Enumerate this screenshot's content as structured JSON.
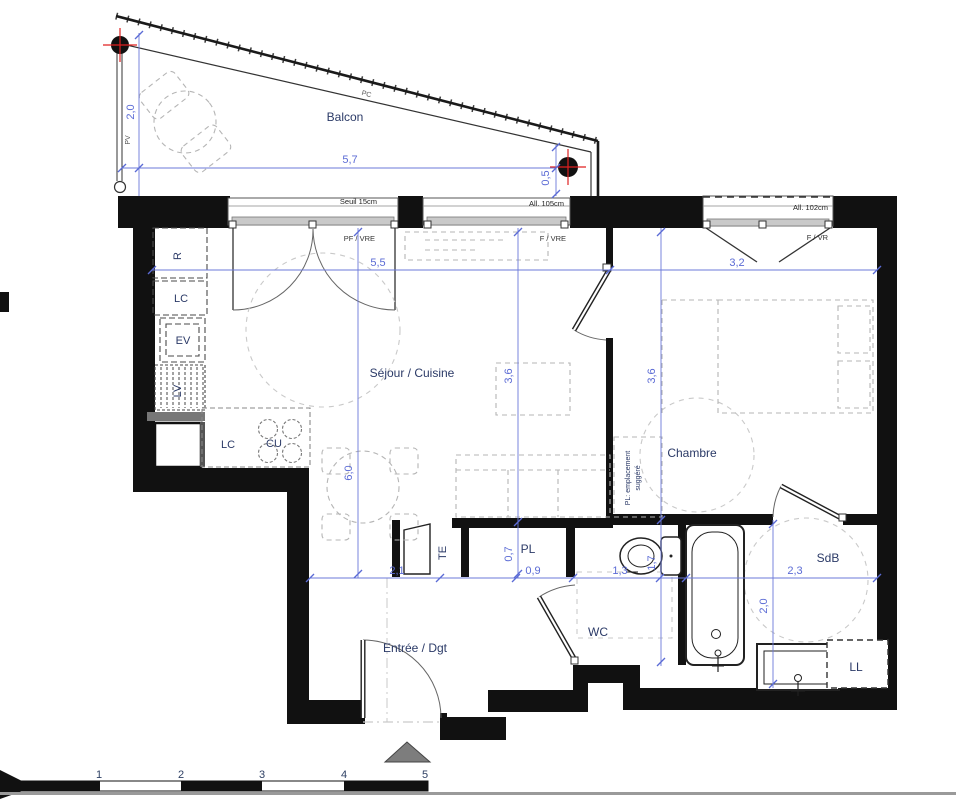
{
  "plan": {
    "rooms": {
      "balcony": "Balcon",
      "living": "Séjour / Cuisine",
      "bedroom": "Chambre",
      "bathroom": "SdB",
      "wc": "WC",
      "entry": "Entrée / Dgt",
      "closet": "PL",
      "washer": "LL"
    },
    "appliances": {
      "fridge": "R",
      "tall_cabinet": "LC",
      "sink_unit": "EV",
      "dishwasher": "LV",
      "low_cabinet": "LC",
      "cooktop": "CU",
      "electrical_panel": "TE"
    },
    "notes": {
      "w1_sill": "Seuil 15cm",
      "w1_type": "PF / VRE",
      "w2_sill": "All. 105cm",
      "w2_type": "F / VRE",
      "w3_sill": "All. 102cm",
      "w3_type": "F / VR",
      "pv": "PV",
      "pc": "PC",
      "pl_suggested_1": "PL: emplacement",
      "pl_suggested_2": "suggéré"
    },
    "dimensions": {
      "balcony_depth": "2,0",
      "balcony_width": "5,7",
      "balcony_offset": "0,5",
      "living_width": "5,5",
      "bedroom_width": "3,2",
      "living_length": "6,0",
      "living_depth": "3,6",
      "bedroom_depth": "3,6",
      "closet_depth": "0,7",
      "entry_width": "2,1",
      "closet_width": "0,9",
      "wc_width": "1,3",
      "wc_depth": "1,7",
      "bathroom_width": "2,3",
      "bathroom_depth": "2,0"
    },
    "scale_bar": {
      "ticks": [
        "1",
        "2",
        "3",
        "4",
        "5"
      ]
    },
    "colors": {
      "wall": "#111111",
      "dimension": "#5b6bd5",
      "room_label": "#2b3a67",
      "furniture": "#b5b5b5",
      "marker_red": "#e02020"
    }
  }
}
